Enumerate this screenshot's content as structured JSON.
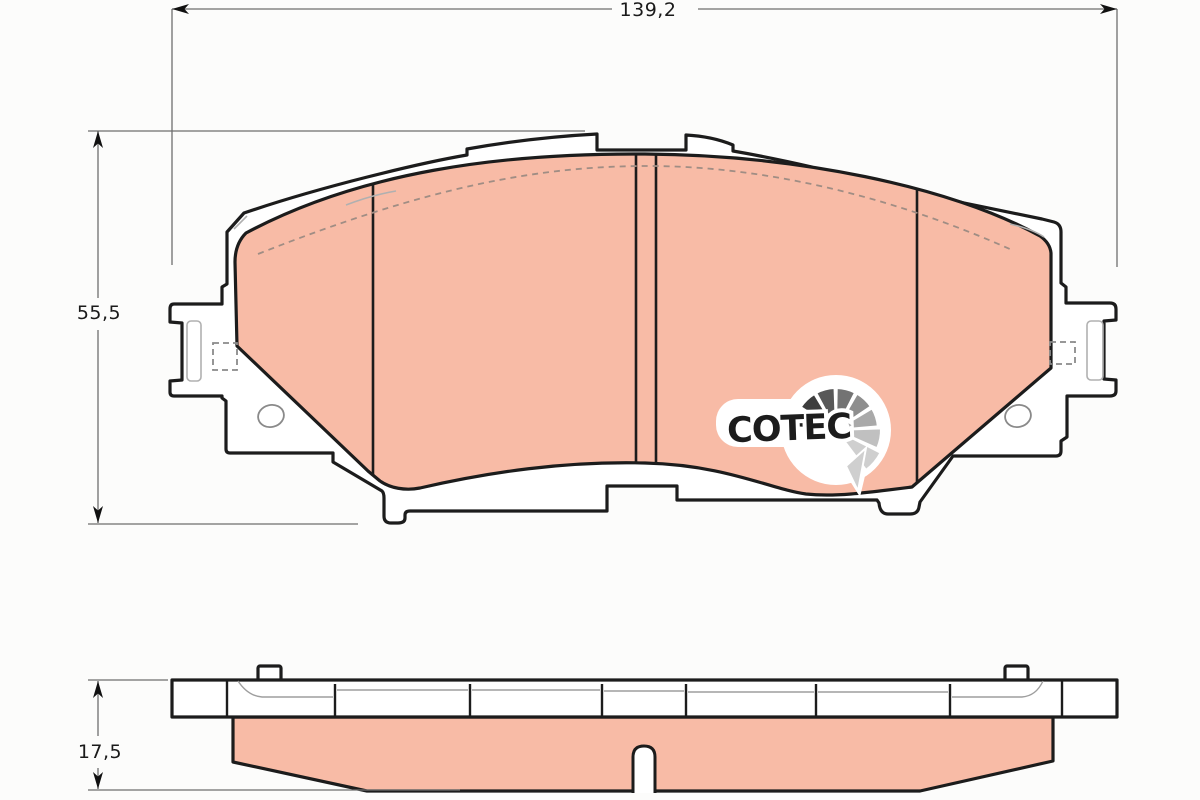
{
  "drawing": {
    "dimensions": {
      "width_label": "139,2",
      "height_label": "55,5",
      "thickness_label": "17,5"
    },
    "logo": {
      "text": "COTEC",
      "fan_colors": [
        "#1f1f1f",
        "#3d3d3d",
        "#585858",
        "#737373",
        "#8e8e8e",
        "#a9a9a9",
        "#c0c0c0",
        "#cfcfcf"
      ]
    },
    "colors": {
      "friction_material": "#f8bba6",
      "outline": "#1c1c1c",
      "dimension_line": "#6e6e6e",
      "detail_line": "#9e9e9e",
      "background": "#fcfcfb"
    }
  }
}
